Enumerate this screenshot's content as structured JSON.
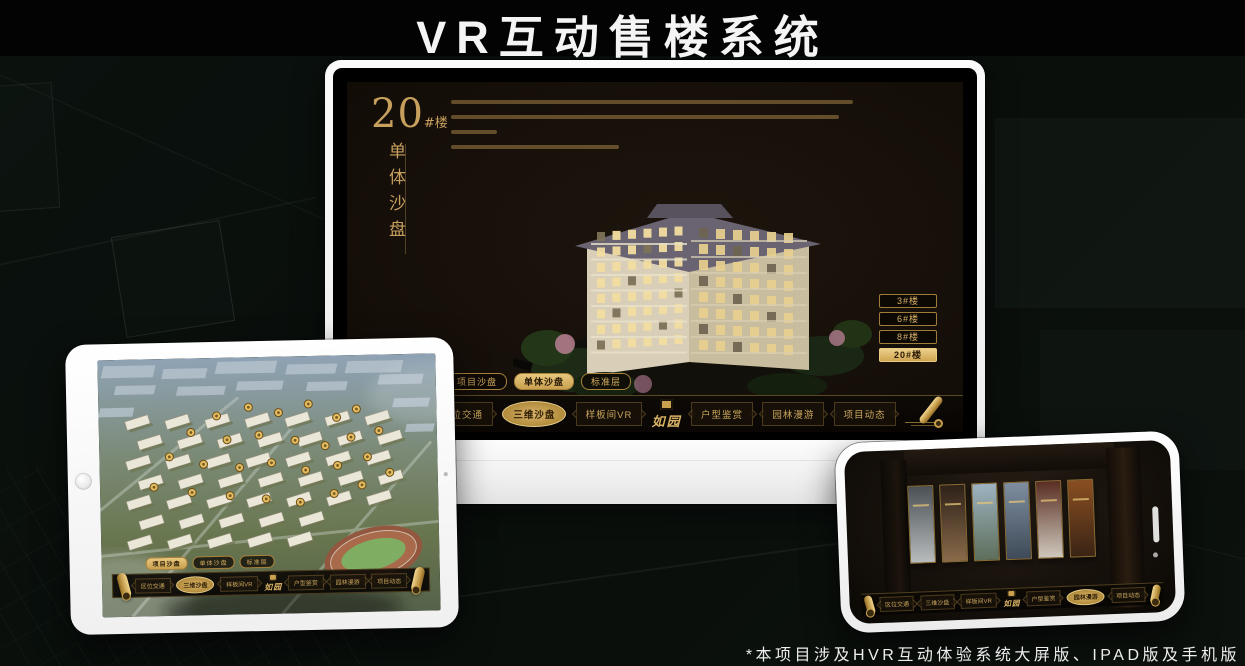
{
  "page": {
    "title": "VR互动售楼系统",
    "footnote": "*本项目涉及HVR互动体验系统大屏版、IPAD版及手机版"
  },
  "colors": {
    "gold": "#c9a55c",
    "gold_bright": "#e8c87e",
    "gold_deep": "#a8813c",
    "active_text": "#2a1a04",
    "screen_bg": "#17100a",
    "nav_bg": "#0b0805",
    "title_text": "#f4f4f4",
    "device_body": "#f5f5f5"
  },
  "monitor": {
    "heading": {
      "number": "20",
      "suffix": "#楼",
      "subtitle": "单体沙盘"
    },
    "building_buttons": [
      {
        "label": "3#楼",
        "active": false
      },
      {
        "label": "6#楼",
        "active": false
      },
      {
        "label": "8#楼",
        "active": false
      },
      {
        "label": "20#楼",
        "active": true
      }
    ],
    "floor_tabs": [
      {
        "label": "项目沙盘",
        "active": false
      },
      {
        "label": "单体沙盘",
        "active": true
      },
      {
        "label": "标准层",
        "active": false
      }
    ],
    "nav": {
      "left_items": [
        {
          "label": "区位交通",
          "active": false
        },
        {
          "label": "三维沙盘",
          "active": true
        },
        {
          "label": "样板间VR",
          "active": false
        }
      ],
      "logo": "如园",
      "right_items": [
        {
          "label": "户型鉴赏",
          "active": false
        },
        {
          "label": "园林漫游",
          "active": false
        },
        {
          "label": "项目动态",
          "active": false
        }
      ],
      "scroll_icon": "scroll"
    }
  },
  "tablet": {
    "floor_tabs": [
      {
        "label": "项目沙盘",
        "active": true
      },
      {
        "label": "单体沙盘",
        "active": false
      },
      {
        "label": "标准层",
        "active": false
      }
    ],
    "nav": {
      "left_items": [
        {
          "label": "区位交通",
          "active": false
        },
        {
          "label": "三维沙盘",
          "active": true
        },
        {
          "label": "样板间VR",
          "active": false
        }
      ],
      "logo": "如园",
      "right_items": [
        {
          "label": "户型鉴赏",
          "active": false
        },
        {
          "label": "园林漫游",
          "active": false
        },
        {
          "label": "项目动态",
          "active": false
        }
      ]
    }
  },
  "phone": {
    "nav": {
      "left_items": [
        {
          "label": "区位交通",
          "active": false
        },
        {
          "label": "三维沙盘",
          "active": false
        },
        {
          "label": "样板间VR",
          "active": false
        }
      ],
      "logo": "如园",
      "right_items": [
        {
          "label": "户型鉴赏",
          "active": false
        },
        {
          "label": "园林漫游",
          "active": true
        },
        {
          "label": "项目动态",
          "active": false
        }
      ]
    },
    "cards": [
      {
        "top": "#4a5055",
        "bottom": "#b8bcbd"
      },
      {
        "top": "#2e2119",
        "bottom": "#8a6b4a"
      },
      {
        "top": "#9db3c0",
        "bottom": "#5d6e5a"
      },
      {
        "top": "#7e8ea0",
        "bottom": "#3e4a57"
      },
      {
        "top": "#5a2e22",
        "bottom": "#cfc8bd"
      },
      {
        "top": "#8a4f22",
        "bottom": "#3a2414"
      }
    ]
  }
}
